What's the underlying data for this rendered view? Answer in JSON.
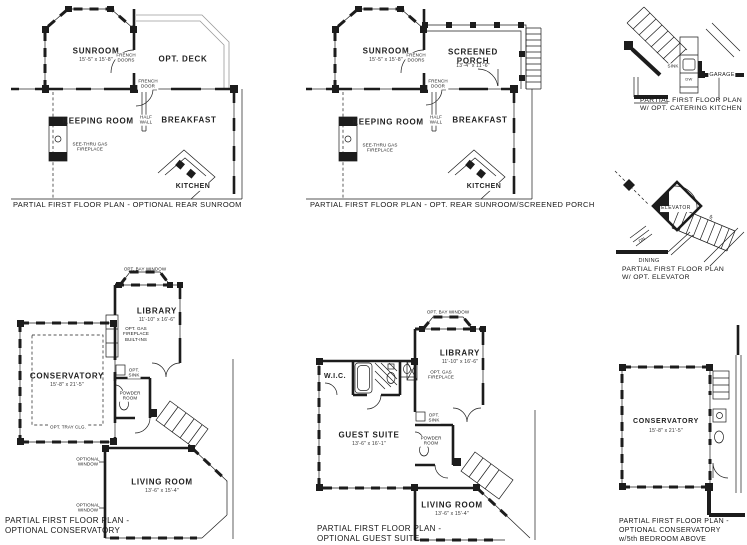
{
  "plans": {
    "rear_sunroom": {
      "caption": "PARTIAL FIRST FLOOR PLAN - OPTIONAL REAR SUNROOM",
      "sunroom_name": "SUNROOM",
      "sunroom_dims": "15'-5\" x 15'-8\"",
      "deck": "OPT. DECK",
      "french_doors": "FRENCH\nDOORS",
      "french_door": "FRENCH\nDOOR",
      "keeping_room": "KEEPING ROOM",
      "half_wall": "HALF\nWALL",
      "breakfast": "BREAKFAST",
      "fireplace": "SEE-THRU GAS\nFIREPLACE",
      "kitchen": "KITCHEN"
    },
    "sunroom_screened_porch": {
      "caption": "PARTIAL FIRST FLOOR PLAN - OPT. REAR SUNROOM/SCREENED PORCH",
      "sunroom_name": "SUNROOM",
      "sunroom_dims": "15'-5\" x 15'-8\"",
      "porch_name": "SCREENED PORCH",
      "porch_dims": "13'-4\" x 11'-6\"",
      "french_doors": "FRENCH\nDOORS",
      "french_door": "FRENCH\nDOOR",
      "keeping_room": "KEEPING ROOM",
      "half_wall": "HALF\nWALL",
      "breakfast": "BREAKFAST",
      "fireplace": "SEE-THRU GAS\nFIREPLACE",
      "kitchen": "KITCHEN"
    },
    "catering_kitchen": {
      "caption": "PARTIAL FIRST FLOOR PLAN\nW/ OPT. CATERING KITCHEN",
      "sink": "SINK",
      "dw": "DW",
      "garage": "GARAGE"
    },
    "elevator": {
      "caption": "PARTIAL FIRST FLOOR PLAN\nW/ OPT. ELEVATOR",
      "elevator": "ELEVATOR",
      "up": "UP",
      "dn": "DN",
      "dining": "DINING"
    },
    "conservatory": {
      "caption": "PARTIAL FIRST FLOOR PLAN -\nOPTIONAL CONSERVATORY",
      "bay_window": "OPT. BAY WINDOW",
      "library_name": "LIBRARY",
      "library_dims": "11'-10\" x 16'-6\"",
      "fireplace": "OPT. GAS\nFIREPLACE\nBUILT-INS",
      "conservatory_name": "CONSERVATORY",
      "conservatory_dims": "15'-8\" x 21'-5\"",
      "opt_sink": "OPT.\nSINK",
      "powder_room": "POWDER\nROOM",
      "tray_ceiling": "OPT. TRAY CLG.",
      "optional_window": "OPTIONAL\nWINDOW",
      "living_room_name": "LIVING ROOM",
      "living_room_dims": "13'-6\" x 15'-4\""
    },
    "guest_suite": {
      "caption": "PARTIAL FIRST FLOOR PLAN -\nOPTIONAL GUEST SUITE",
      "bay_window": "OPT. BAY WINDOW",
      "library_name": "LIBRARY",
      "library_dims": "11'-10\" x 16'-6\"",
      "fireplace": "OPT. GAS\nFIREPLACE",
      "wic": "W.I.C.",
      "guest_suite_name": "GUEST SUITE",
      "guest_suite_dims": "13'-6\" x 16'-1\"",
      "opt_sink": "OPT.\nSINK",
      "powder_room": "POWDER\nROOM",
      "living_room_name": "LIVING ROOM",
      "living_room_dims": "13'-6\" x 15'-4\""
    },
    "conservatory_bedroom": {
      "caption": "PARTIAL FIRST FLOOR PLAN -\nOPTIONAL CONSERVATORY\nw/5th BEDROOM ABOVE",
      "conservatory_name": "CONSERVATORY",
      "conservatory_dims": "15'-8\" x 21'-5\""
    }
  }
}
